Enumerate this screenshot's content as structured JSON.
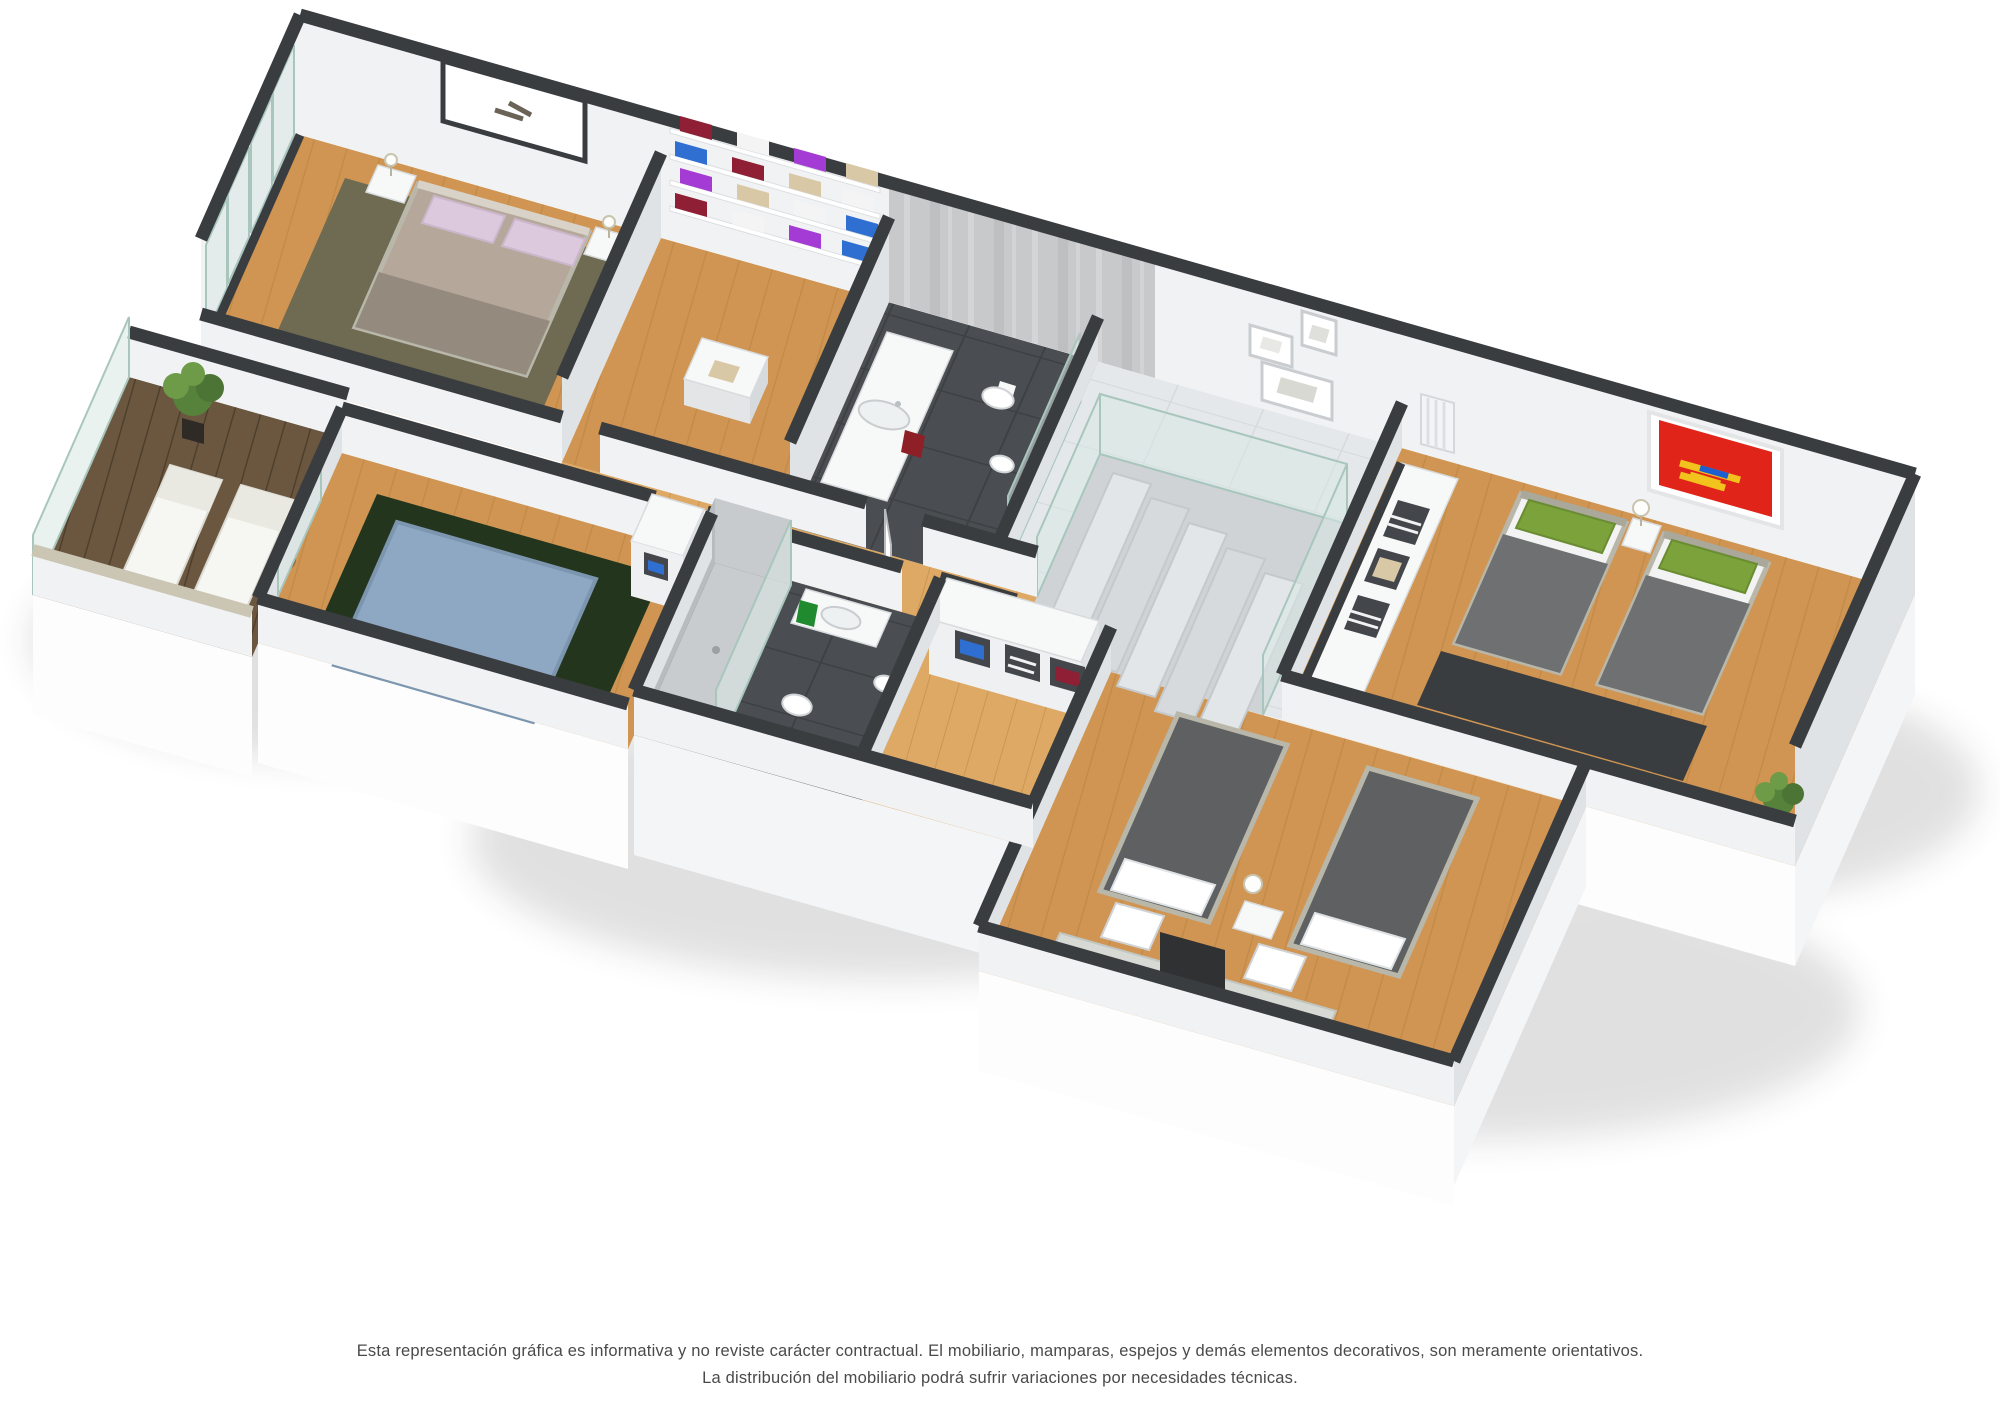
{
  "scene": {
    "type": "3d-isometric-floorplan-render",
    "rooms": [
      "master-bedroom",
      "walk-in-closet",
      "bathroom-1",
      "hallway-stairs",
      "bedroom-2",
      "terrace",
      "bathroom-2",
      "wardrobe-corridor",
      "bedroom-3",
      "bedroom-4"
    ]
  },
  "disclaimer": {
    "line1": "Esta representación gráfica es informativa y no reviste carácter contractual. El mobiliario, mamparas, espejos y demás elementos decorativos, son meramente orientativos.",
    "line2": "La distribución del mobiliario podrá sufrir variaciones por necesidades técnicas."
  },
  "colors": {
    "text": "#4a4a4a",
    "wall_top": "#3a3d40",
    "wall_face": "#f1f2f3",
    "wall_shade": "#e0e3e5",
    "wood": "#d09552",
    "wood_light": "#dda964",
    "wood_line": "#b07a3a",
    "deck": "#6b5740",
    "deck_line": "#4e3f2d",
    "tile": "#4a4d51",
    "tile_line": "#3e4144",
    "marble": "#e5e8ea",
    "marble_line": "#d6dadd",
    "concrete": "#c7c9ca",
    "glass": "#d9e7e3",
    "glass_edge": "#a9c6bd",
    "rug_olive": "#6f6a52",
    "rug_green": "#24351e",
    "rug_dark": "#3a3d40",
    "bed_taupe": "#b5a89a",
    "bed_taupe_dark": "#90867a",
    "pillow_lilac": "#ddc9dd",
    "bed_blue": "#8ea8c3",
    "bed_frame": "#b8b7aa",
    "blanket_gray": "#6e7072",
    "mattress_dark": "#5e6062",
    "pillow_green": "#7ba23b",
    "white_furniture": "#f7f8f8",
    "art_red": "#e0241a",
    "towel_red": "#8e1f26",
    "towel_green": "#1f8a2e",
    "plant_dark": "#4c7434",
    "plant": "#57823c",
    "plant_light": "#6d9b47",
    "clothes_red": "#8e1f35",
    "clothes_purple": "#a43bd4",
    "clothes_blue": "#2e6fd1",
    "clothes_beige": "#d9c8a6",
    "clothes_pink": "#d98ca0",
    "clothes_gray": "#8b8f93",
    "stone_cap": "#cbc5b4"
  }
}
